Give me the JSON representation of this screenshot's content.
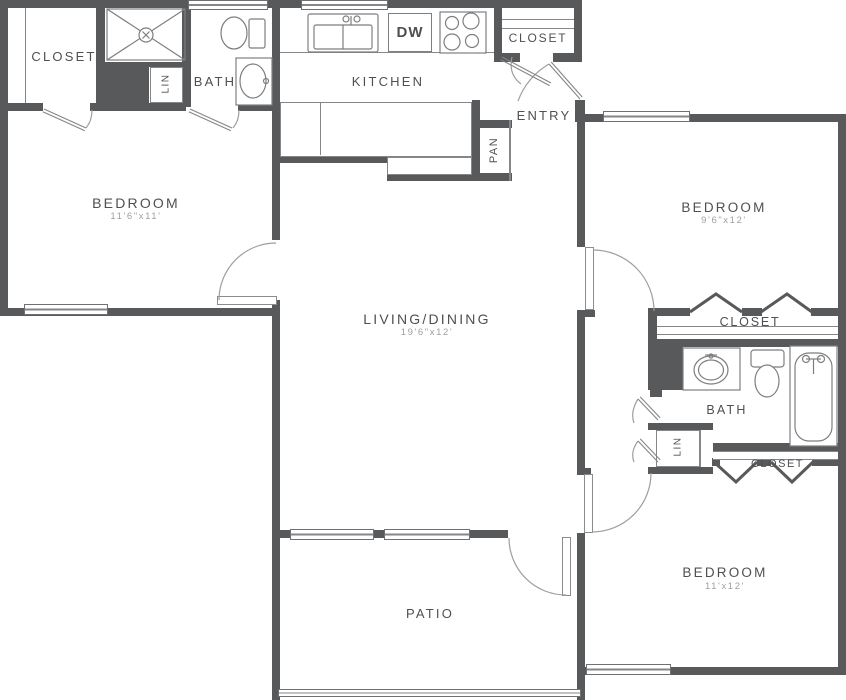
{
  "plan_type": "apartment-floor-plan",
  "colors": {
    "wall": "#58595b",
    "thin_line": "#85868a",
    "door_arc": "#9d9ea0",
    "label_text": "#4e5054",
    "dimension_text": "#a0a0a3",
    "background": "#ffffff"
  },
  "labels": {
    "closet_top_left": "CLOSET",
    "lin_left": "LIN",
    "bath_left": "BATH",
    "bedroom_left": "BEDROOM",
    "bedroom_left_dims": "11'6\"x11'",
    "kitchen": "KITCHEN",
    "dishwasher": "DW",
    "closet_entry": "CLOSET",
    "entry": "ENTRY",
    "pantry": "PAN",
    "living": "LIVING/DINING",
    "living_dims": "19'6\"x12'",
    "bedroom_top_right": "BEDROOM",
    "bedroom_top_right_dims": "9'6\"x12'",
    "closet_mid_right": "CLOSET",
    "bath_right": "BATH",
    "lin_right": "LIN",
    "closet_bottom_right": "CLOSET",
    "bedroom_bottom_right": "BEDROOM",
    "bedroom_bottom_right_dims": "11'x12'",
    "patio": "PATIO"
  },
  "fixtures": [
    "shower",
    "toilet",
    "vanity-sink",
    "kitchen-sink",
    "dishwasher",
    "stove",
    "bathtub"
  ]
}
